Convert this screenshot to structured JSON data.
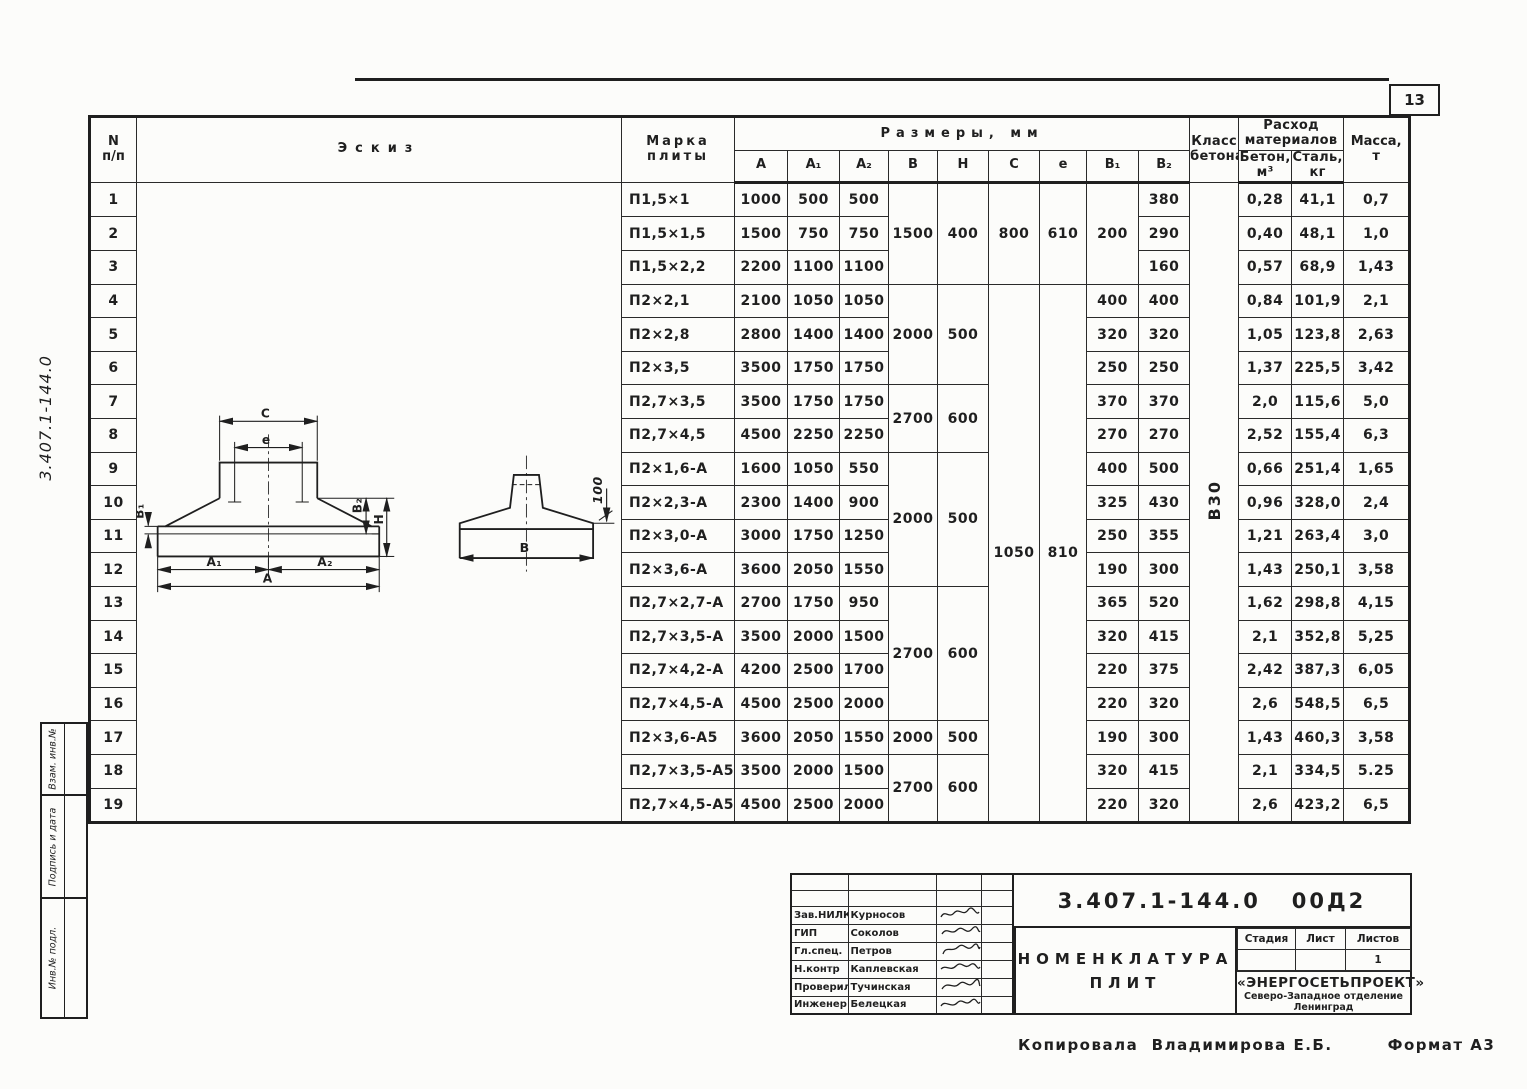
{
  "page": {
    "number": "13",
    "margin": {
      "doc_number_vertical": "3.407.1-144.0",
      "stamps": [
        "Взам. инв.№",
        "Подпись и дата",
        "Инв.№ подл."
      ]
    },
    "copied": {
      "label": "Копировала",
      "name": "Владимирова Е.Б.",
      "format": "Формат А3"
    }
  },
  "table": {
    "concrete_class": "В30",
    "header": {
      "num_line1": "N",
      "num_line2": "п/п",
      "sketch": "Эскиз",
      "mark_line1": "Марка",
      "mark_line2": "плиты",
      "sizes": "Размеры, мм",
      "size_cols": [
        "А",
        "А₁",
        "А₂",
        "В",
        "Н",
        "С",
        "е",
        "В₁",
        "В₂"
      ],
      "class_line1": "Класс",
      "class_line2": "бетона",
      "materials_line1": "Расход",
      "materials_line2": "материалов",
      "material_cols": [
        {
          "l1": "Бетон,",
          "l2": "м³"
        },
        {
          "l1": "Сталь,",
          "l2": "кг"
        }
      ],
      "mass_line1": "Масса,",
      "mass_line2": "т"
    },
    "rows": [
      {
        "n": "1",
        "mark": "П1,5×1",
        "a": "1000",
        "a1": "500",
        "a2": "500",
        "b": "1500",
        "h": "400",
        "c": "800",
        "e": "610",
        "b1": "200",
        "b2": "380",
        "beton": "0,28",
        "stal": "41,1",
        "massa": "0,7"
      },
      {
        "n": "2",
        "mark": "П1,5×1,5",
        "a": "1500",
        "a1": "750",
        "a2": "750",
        "b2": "290",
        "beton": "0,40",
        "stal": "48,1",
        "massa": "1,0"
      },
      {
        "n": "3",
        "mark": "П1,5×2,2",
        "a": "2200",
        "a1": "1100",
        "a2": "1100",
        "b2": "160",
        "beton": "0,57",
        "stal": "68,9",
        "massa": "1,43"
      },
      {
        "n": "4",
        "mark": "П2×2,1",
        "a": "2100",
        "a1": "1050",
        "a2": "1050",
        "b": "2000",
        "h": "500",
        "c": "1050",
        "e": "810",
        "b1": "400",
        "b2": "400",
        "beton": "0,84",
        "stal": "101,9",
        "massa": "2,1"
      },
      {
        "n": "5",
        "mark": "П2×2,8",
        "a": "2800",
        "a1": "1400",
        "a2": "1400",
        "b1": "320",
        "b2": "320",
        "beton": "1,05",
        "stal": "123,8",
        "massa": "2,63"
      },
      {
        "n": "6",
        "mark": "П2×3,5",
        "a": "3500",
        "a1": "1750",
        "a2": "1750",
        "b1": "250",
        "b2": "250",
        "beton": "1,37",
        "stal": "225,5",
        "massa": "3,42"
      },
      {
        "n": "7",
        "mark": "П2,7×3,5",
        "a": "3500",
        "a1": "1750",
        "a2": "1750",
        "b": "2700",
        "h": "600",
        "b1": "370",
        "b2": "370",
        "beton": "2,0",
        "stal": "115,6",
        "massa": "5,0"
      },
      {
        "n": "8",
        "mark": "П2,7×4,5",
        "a": "4500",
        "a1": "2250",
        "a2": "2250",
        "b1": "270",
        "b2": "270",
        "beton": "2,52",
        "stal": "155,4",
        "massa": "6,3"
      },
      {
        "n": "9",
        "mark": "П2×1,6-А",
        "a": "1600",
        "a1": "1050",
        "a2": "550",
        "b": "2000",
        "h": "500",
        "b1": "400",
        "b2": "500",
        "beton": "0,66",
        "stal": "251,4",
        "massa": "1,65"
      },
      {
        "n": "10",
        "mark": "П2×2,3-А",
        "a": "2300",
        "a1": "1400",
        "a2": "900",
        "b1": "325",
        "b2": "430",
        "beton": "0,96",
        "stal": "328,0",
        "massa": "2,4"
      },
      {
        "n": "11",
        "mark": "П2×3,0-А",
        "a": "3000",
        "a1": "1750",
        "a2": "1250",
        "b1": "250",
        "b2": "355",
        "beton": "1,21",
        "stal": "263,4",
        "massa": "3,0"
      },
      {
        "n": "12",
        "mark": "П2×3,6-А",
        "a": "3600",
        "a1": "2050",
        "a2": "1550",
        "b1": "190",
        "b2": "300",
        "beton": "1,43",
        "stal": "250,1",
        "massa": "3,58"
      },
      {
        "n": "13",
        "mark": "П2,7×2,7-А",
        "a": "2700",
        "a1": "1750",
        "a2": "950",
        "b": "2700",
        "h": "600",
        "b1": "365",
        "b2": "520",
        "beton": "1,62",
        "stal": "298,8",
        "massa": "4,15"
      },
      {
        "n": "14",
        "mark": "П2,7×3,5-А",
        "a": "3500",
        "a1": "2000",
        "a2": "1500",
        "b1": "320",
        "b2": "415",
        "beton": "2,1",
        "stal": "352,8",
        "massa": "5,25"
      },
      {
        "n": "15",
        "mark": "П2,7×4,2-А",
        "a": "4200",
        "a1": "2500",
        "a2": "1700",
        "b1": "220",
        "b2": "375",
        "beton": "2,42",
        "stal": "387,3",
        "massa": "6,05"
      },
      {
        "n": "16",
        "mark": "П2,7×4,5-А",
        "a": "4500",
        "a1": "2500",
        "a2": "2000",
        "b1": "220",
        "b2": "320",
        "beton": "2,6",
        "stal": "548,5",
        "massa": "6,5"
      },
      {
        "n": "17",
        "mark": "П2×3,6-А5",
        "a": "3600",
        "a1": "2050",
        "a2": "1550",
        "b": "2000",
        "h": "500",
        "b1": "190",
        "b2": "300",
        "beton": "1,43",
        "stal": "460,3",
        "massa": "3,58"
      },
      {
        "n": "18",
        "mark": "П2,7×3,5-А5",
        "a": "3500",
        "a1": "2000",
        "a2": "1500",
        "b": "2700",
        "h": "600",
        "b1": "320",
        "b2": "415",
        "beton": "2,1",
        "stal": "334,5",
        "massa": "5.25"
      },
      {
        "n": "19",
        "mark": "П2,7×4,5-А5",
        "a": "4500",
        "a1": "2500",
        "a2": "2000",
        "b1": "220",
        "b2": "320",
        "beton": "2,6",
        "stal": "423,2",
        "massa": "6,5"
      }
    ]
  },
  "sketch": {
    "labels": {
      "c": "С",
      "e": "е",
      "b1": "В₁",
      "b2": "В₂",
      "h": "Н",
      "a1": "А₁",
      "a2": "А₂",
      "a": "А",
      "b": "В",
      "dim100": "100"
    }
  },
  "title_block": {
    "doc_number": "3.407.1-144.0   00Д2",
    "title_line1": "Номенклатура",
    "title_line2": "плит",
    "stage": {
      "cols": [
        "Стадия",
        "Лист",
        "Листов"
      ],
      "stage_val": "",
      "sheet_val": "",
      "sheets_total": "1"
    },
    "org_line1": "«ЭНЕРГОСЕТЬПРОЕКТ»",
    "org_line2": "Северо-Западное отделение",
    "org_line3": "Ленинград",
    "signatures": [
      {
        "role": "Зав.НИЛКЭ",
        "name": "Курносов"
      },
      {
        "role": "ГИП",
        "name": "Соколов"
      },
      {
        "role": "Гл.спец.",
        "name": "Петров"
      },
      {
        "role": "Н.контр",
        "name": "Каплевская"
      },
      {
        "role": "Проверил",
        "name": "Тучинская"
      },
      {
        "role": "Инженер",
        "name": "Белецкая"
      }
    ]
  }
}
